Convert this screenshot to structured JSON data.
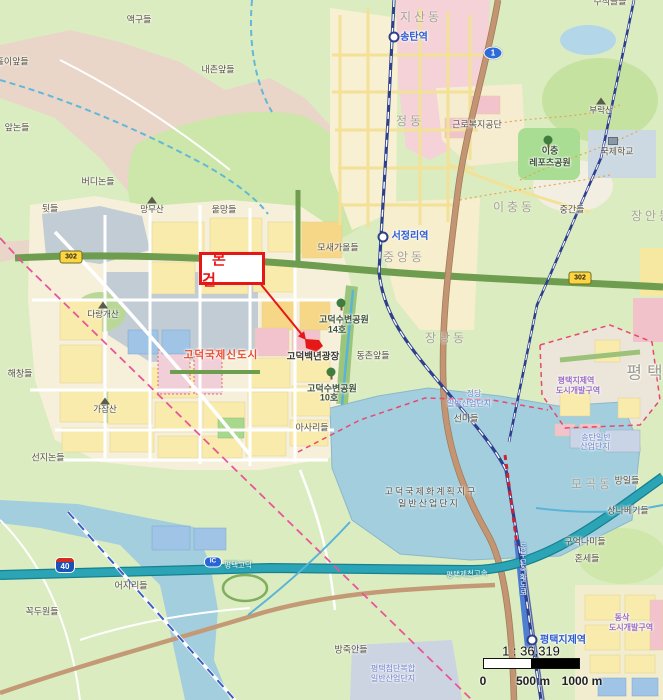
{
  "map": {
    "annotation": {
      "label": "본 건"
    },
    "scale": {
      "ratio": "1 : 36,319",
      "ticks": [
        "0",
        "500 m",
        "1000 m"
      ]
    },
    "colors": {
      "accent_red": "#e61717",
      "water": "#a3cede",
      "forest_green": "#dcecc1",
      "expressway_teal": "#2ba4b6",
      "railway_navy": "#2e3f8e",
      "boundary_pink": "#e8559a",
      "newtown_red_label": "#ea4a2d",
      "station_blue": "#2d5bd1"
    },
    "shields": [
      {
        "kind": "national",
        "label": "1",
        "x": 493,
        "y": 53
      },
      {
        "kind": "local",
        "label": "302",
        "x": 71,
        "y": 257
      },
      {
        "kind": "local",
        "label": "302",
        "x": 580,
        "y": 278
      },
      {
        "kind": "expwy",
        "label": "40",
        "x": 65,
        "y": 565
      },
      {
        "kind": "ic",
        "label": "IC",
        "x": 213,
        "y": 562
      }
    ],
    "stations": [
      {
        "name": "송탄역",
        "x": 394,
        "y": 37
      },
      {
        "name": "서정리역",
        "x": 383,
        "y": 237
      },
      {
        "name": "평택지제역",
        "x": 532,
        "y": 640
      }
    ],
    "icons": [
      {
        "kind": "mountain",
        "x": 601,
        "y": 101
      },
      {
        "kind": "mountain",
        "x": 152,
        "y": 200
      },
      {
        "kind": "mountain",
        "x": 103,
        "y": 305
      },
      {
        "kind": "mountain",
        "x": 105,
        "y": 401
      },
      {
        "kind": "tree",
        "x": 548,
        "y": 140
      },
      {
        "kind": "tree",
        "x": 341,
        "y": 303
      },
      {
        "kind": "tree",
        "x": 331,
        "y": 372
      },
      {
        "kind": "school",
        "x": 613,
        "y": 141
      }
    ],
    "labels": [
      {
        "text": "액구들",
        "x": 139,
        "y": 20,
        "cls": "place"
      },
      {
        "text": "쇠훌이앞들",
        "x": 8,
        "y": 62,
        "cls": "place"
      },
      {
        "text": "내촌앞들",
        "x": 218,
        "y": 70,
        "cls": "place"
      },
      {
        "text": "앞논들",
        "x": 17,
        "y": 128,
        "cls": "place"
      },
      {
        "text": "수직골들",
        "x": 610,
        "y": 2,
        "cls": "place"
      },
      {
        "text": "지산동",
        "x": 421,
        "y": 17,
        "cls": "area"
      },
      {
        "text": "송탄역",
        "x": 414,
        "y": 38,
        "cls": "station"
      },
      {
        "text": "정동",
        "x": 410,
        "y": 121,
        "cls": "area"
      },
      {
        "text": "근로복지공단",
        "x": 477,
        "y": 125,
        "cls": "place"
      },
      {
        "text": "부락산",
        "x": 601,
        "y": 110,
        "cls": "mountain"
      },
      {
        "text": "이충",
        "x": 550,
        "y": 151,
        "cls": "park"
      },
      {
        "text": "레포츠공원",
        "x": 550,
        "y": 163,
        "cls": "park"
      },
      {
        "text": "국제학교",
        "x": 617,
        "y": 152,
        "cls": "place"
      },
      {
        "text": "장안동",
        "x": 652,
        "y": 216,
        "cls": "area"
      },
      {
        "text": "중간들",
        "x": 572,
        "y": 210,
        "cls": "place"
      },
      {
        "text": "이충동",
        "x": 514,
        "y": 207,
        "cls": "area"
      },
      {
        "text": "버디논들",
        "x": 98,
        "y": 182,
        "cls": "place"
      },
      {
        "text": "뒷들",
        "x": 50,
        "y": 209,
        "cls": "place"
      },
      {
        "text": "망무산",
        "x": 152,
        "y": 209,
        "cls": "mountain"
      },
      {
        "text": "울망들",
        "x": 224,
        "y": 210,
        "cls": "place"
      },
      {
        "text": "모새가올들",
        "x": 338,
        "y": 248,
        "cls": "place"
      },
      {
        "text": "서정리역",
        "x": 410,
        "y": 237,
        "cls": "station"
      },
      {
        "text": "중앙동",
        "x": 404,
        "y": 257,
        "cls": "area"
      },
      {
        "text": "장당동",
        "x": 446,
        "y": 338,
        "cls": "area"
      },
      {
        "text": "고덕국제신도시",
        "x": 221,
        "y": 355,
        "cls": "red"
      },
      {
        "text": "고덕백년광장",
        "x": 313,
        "y": 357,
        "cls": "plaza"
      },
      {
        "text": "동촌앞들",
        "x": 373,
        "y": 356,
        "cls": "place"
      },
      {
        "text": "고덕수변공원",
        "x": 344,
        "y": 320,
        "cls": "park"
      },
      {
        "text": "14호",
        "x": 337,
        "y": 330,
        "cls": "park"
      },
      {
        "text": "고덕수변공원",
        "x": 332,
        "y": 389,
        "cls": "park"
      },
      {
        "text": "10호",
        "x": 329,
        "y": 398,
        "cls": "park"
      },
      {
        "text": "아사리들",
        "x": 312,
        "y": 428,
        "cls": "place"
      },
      {
        "text": "해창들",
        "x": 20,
        "y": 374,
        "cls": "place"
      },
      {
        "text": "다랑개산",
        "x": 103,
        "y": 314,
        "cls": "mountain"
      },
      {
        "text": "가잠산",
        "x": 105,
        "y": 409,
        "cls": "mountain"
      },
      {
        "text": "선지논들",
        "x": 48,
        "y": 458,
        "cls": "place"
      },
      {
        "text": "정당",
        "x": 474,
        "y": 394,
        "cls": "ind"
      },
      {
        "text": "일반산업단지",
        "x": 469,
        "y": 404,
        "cls": "ind"
      },
      {
        "text": "선미들",
        "x": 466,
        "y": 419,
        "cls": "place"
      },
      {
        "text": "평택",
        "x": 647,
        "y": 373,
        "cls": "area-xl"
      },
      {
        "text": "평택지제역",
        "x": 576,
        "y": 381,
        "cls": "purple"
      },
      {
        "text": "도시개발구역",
        "x": 578,
        "y": 391,
        "cls": "purple"
      },
      {
        "text": "송탄일반",
        "x": 596,
        "y": 438,
        "cls": "ind"
      },
      {
        "text": "산업단지",
        "x": 595,
        "y": 447,
        "cls": "ind"
      },
      {
        "text": "고덕국제화계획지구",
        "x": 431,
        "y": 492,
        "cls": "zone"
      },
      {
        "text": "일반산업단지",
        "x": 429,
        "y": 504,
        "cls": "zone"
      },
      {
        "text": "모곡동",
        "x": 592,
        "y": 484,
        "cls": "area"
      },
      {
        "text": "방일들",
        "x": 627,
        "y": 481,
        "cls": "place"
      },
      {
        "text": "상나베기들",
        "x": 628,
        "y": 511,
        "cls": "place"
      },
      {
        "text": "구억나미들",
        "x": 585,
        "y": 542,
        "cls": "place"
      },
      {
        "text": "혼세들",
        "x": 587,
        "y": 559,
        "cls": "place"
      },
      {
        "text": "평택제천고속",
        "x": 467,
        "y": 574,
        "cls": "hwy",
        "rot": -3
      },
      {
        "text": "동부고속화도로",
        "x": 523,
        "y": 569,
        "cls": "hwy-v"
      },
      {
        "text": "평택고덕",
        "x": 238,
        "y": 565,
        "cls": "hwy"
      },
      {
        "text": "어지리들",
        "x": 131,
        "y": 586,
        "cls": "place"
      },
      {
        "text": "꼭두원들",
        "x": 42,
        "y": 612,
        "cls": "place"
      },
      {
        "text": "방죽안들",
        "x": 351,
        "y": 650,
        "cls": "place"
      },
      {
        "text": "평택첨단복합",
        "x": 393,
        "y": 669,
        "cls": "ind"
      },
      {
        "text": "일반산업단지",
        "x": 393,
        "y": 679,
        "cls": "ind"
      },
      {
        "text": "평택지제역",
        "x": 563,
        "y": 641,
        "cls": "station"
      },
      {
        "text": "동삭",
        "x": 622,
        "y": 618,
        "cls": "purple"
      },
      {
        "text": "도시개발구역",
        "x": 631,
        "y": 628,
        "cls": "purple"
      }
    ]
  }
}
